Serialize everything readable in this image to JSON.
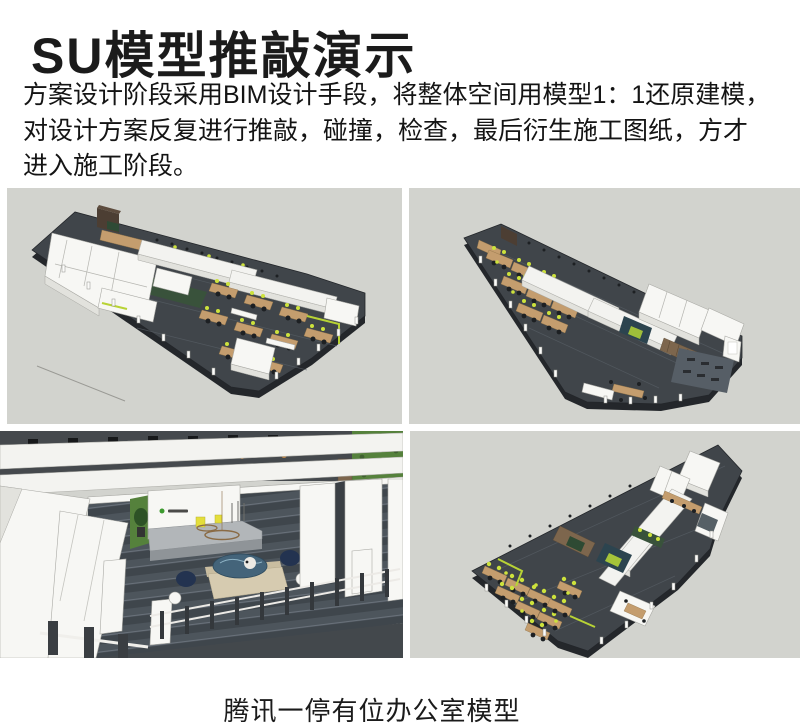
{
  "page": {
    "title": "SU模型推敲演示",
    "paragraph_lines": [
      "方案设计阶段采用BIM设计手段，将整体空间用模型1：1还原建模，",
      "对设计方案反复进行推敲，碰撞，检查，最后衍生施工图纸，方才",
      "进入施工阶段。"
    ],
    "caption": "腾讯一停有位办公室模型"
  },
  "images": [
    {
      "name": "su-model-axonometric-view-1"
    },
    {
      "name": "su-model-axonometric-view-2"
    },
    {
      "name": "su-model-reception-interior-view"
    },
    {
      "name": "su-model-axonometric-view-3"
    }
  ],
  "colors": {
    "canvas_background": "#d2d3ce",
    "floor_slab": "#40454a",
    "accent_lime": "#cde23c",
    "desk_wood": "#c49d6e",
    "plant_green": "#55813c",
    "sofa_navy": "#233350",
    "highlight_yellow": "#e4de3b",
    "text": "#1b1b1b"
  }
}
